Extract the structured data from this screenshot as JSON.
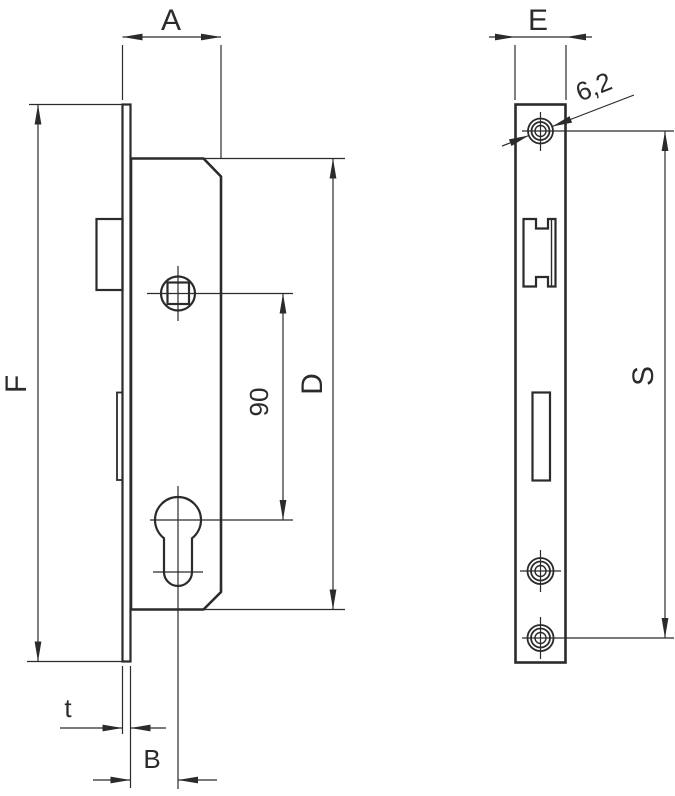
{
  "drawing": {
    "kind": "mortise-lock-technical-drawing",
    "labels": {
      "a": "A",
      "e": "E",
      "f": "F",
      "d": "D",
      "s": "S",
      "b": "B",
      "t": "t",
      "centers": "90",
      "hole_dia": "6,2"
    },
    "colors": {
      "line": "#2b2b2b",
      "background": "#ffffff"
    }
  }
}
